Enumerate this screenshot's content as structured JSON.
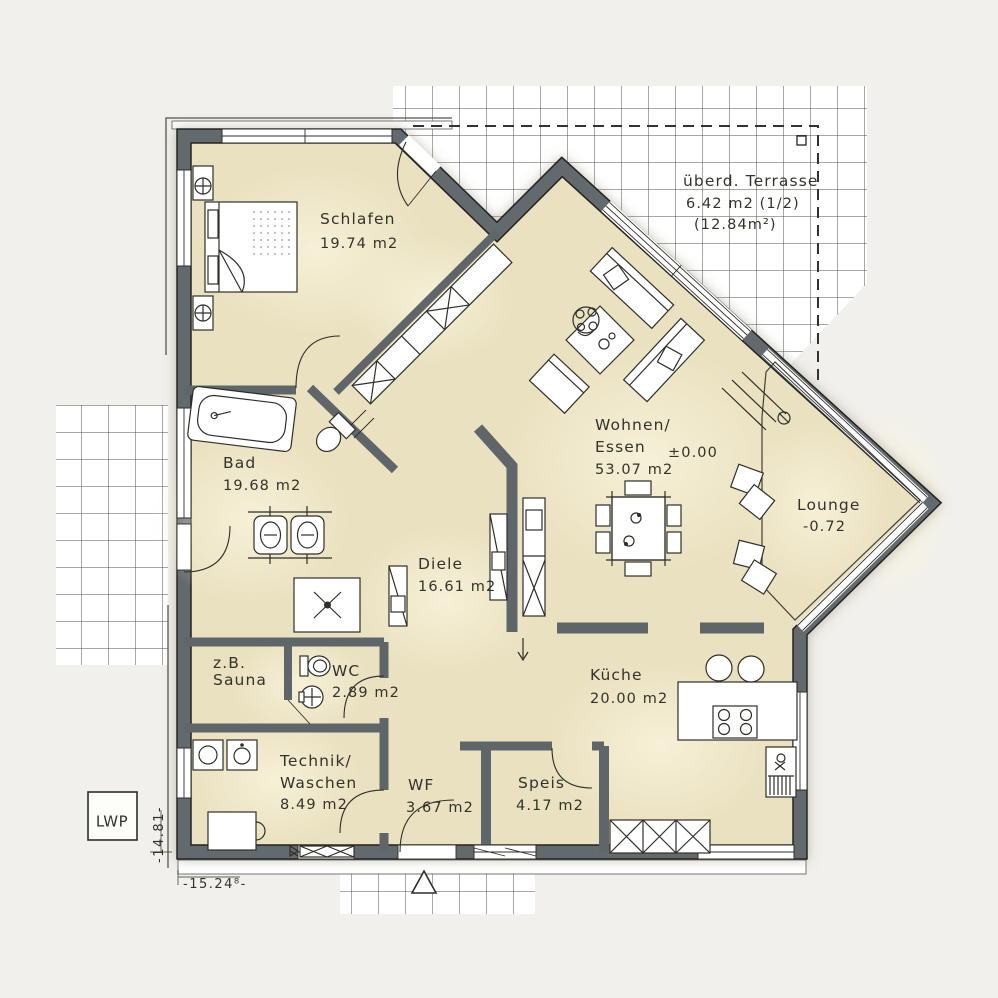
{
  "plan": {
    "type": "floorplan",
    "rooms": [
      {
        "id": "schlafen",
        "name": "Schlafen",
        "area": "19.74 m2"
      },
      {
        "id": "terrasse",
        "name": "überd. Terrasse",
        "area": "6.42 m2 (1/2)",
        "area2": "(12.84m²)"
      },
      {
        "id": "bad",
        "name": "Bad",
        "area": "19.68 m2"
      },
      {
        "id": "wohnen_essen",
        "name": "Wohnen/",
        "name2": "Essen",
        "area": "53.07 m2",
        "level": "±0.00"
      },
      {
        "id": "lounge",
        "name": "Lounge",
        "level": "-0.72"
      },
      {
        "id": "diele",
        "name": "Diele",
        "area": "16.61 m2"
      },
      {
        "id": "sauna",
        "name": "z.B.",
        "name2": "Sauna"
      },
      {
        "id": "wc",
        "name": "WC",
        "area": "2.89 m2"
      },
      {
        "id": "technik_waschen",
        "name": "Technik/",
        "name2": "Waschen",
        "area": "8.49 m2"
      },
      {
        "id": "wf",
        "name": "WF",
        "area": "3.67 m2"
      },
      {
        "id": "speis",
        "name": "Speis",
        "area": "4.17 m2"
      },
      {
        "id": "kueche",
        "name": "Küche",
        "area": "20.00 m2"
      }
    ],
    "equipment": {
      "heat_pump_label": "LWP"
    },
    "dimensions": {
      "width_label": "-15.24⁸-",
      "height_label": "-14.81-"
    },
    "colors": {
      "background": "#f1f0ec",
      "floor": "#eae1c0",
      "wall": "#646b6e",
      "wall_edge": "#222222",
      "line": "#2e2e29",
      "text": "#33332c",
      "terrace": "#ffffff",
      "grid_line": "#4f4f4f"
    }
  }
}
